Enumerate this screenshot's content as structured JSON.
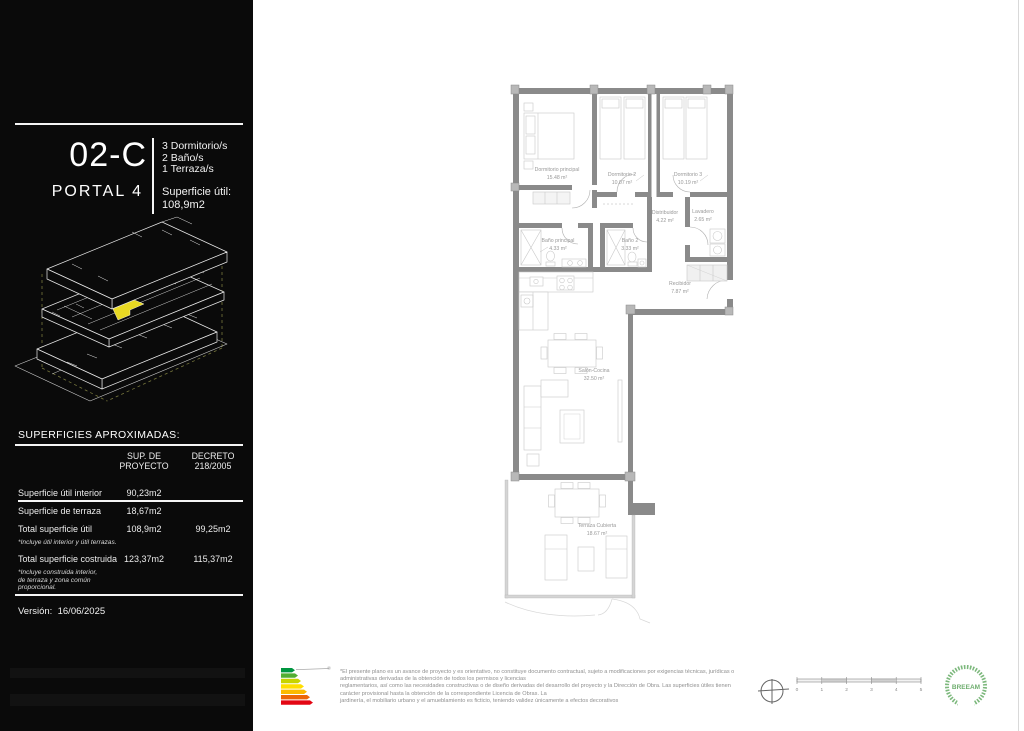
{
  "sidebar": {
    "unit_code": "02-C",
    "portal": "PORTAL 4",
    "features": [
      "3 Dormitorio/s",
      "2 Baño/s",
      "1 Terraza/s"
    ],
    "superficie_util_label": "Superficie útil:",
    "superficie_util_value": "108,9m2",
    "table": {
      "title": "SUPERFICIES APROXIMADAS:",
      "col_proyecto": "SUP. DE\nPROYECTO",
      "col_decreto": "DECRETO\n218/2005",
      "rows": [
        {
          "label": "Superficie útil interior",
          "proyecto": "90,23m2",
          "decreto": ""
        },
        {
          "label": "Superficie de terraza",
          "proyecto": "18,67m2",
          "decreto": ""
        },
        {
          "label": "Total superficie útil",
          "proyecto": "108,9m2",
          "decreto": "99,25m2",
          "note": "*Incluye útil interior y útil terrazas."
        },
        {
          "label": "Total superficie costruida",
          "proyecto": "123,37m2",
          "decreto": "115,37m2",
          "note": "*Incluye construida interior,\nde terraza y zona común\nproporcional."
        }
      ]
    },
    "version_label": "Versión:",
    "version_value": "16/06/2025"
  },
  "plan": {
    "rooms": [
      {
        "name": "Dormitorio principal",
        "area": "15.48 m²"
      },
      {
        "name": "Dormitorio 2",
        "area": "10.07 m²"
      },
      {
        "name": "Dormitorio 3",
        "area": "10.19 m²"
      },
      {
        "name": "Distribuidor",
        "area": "4.22 m²"
      },
      {
        "name": "Lavadero",
        "area": "2.65 m²"
      },
      {
        "name": "Baño principal",
        "area": "4.33 m²"
      },
      {
        "name": "Baño 2",
        "area": "3.33 m²"
      },
      {
        "name": "Recibidor",
        "area": "7.87 m²"
      },
      {
        "name": "Salón-Cocina",
        "area": "32.50 m²"
      },
      {
        "name": "Terraza Cubierta",
        "area": "18.67 m²"
      }
    ]
  },
  "footer": {
    "disclaimer_lines": [
      "*El presente plano es un avance de proyecto y es orientativo, no constituye documento contractual, sujeto a modificaciones por exigencias técnicas, jurídicas o",
      "administrativas derivadas de la obtención de todos los permisos y licencias",
      "reglamentarios, así como las necesidades constructivas o de diseño derivadas del desarrollo del proyecto y la Dirección de Obra. Las superficies útiles tienen",
      "carácter provisional hasta la obtención de la correspondiente Licencia de Obras. La",
      "jardinería, el mobiliario urbano y el amueblamiento es ficticio, teniendo validez únicamente a efectos decorativos"
    ],
    "scale_ticks": [
      "0",
      "1",
      "2",
      "3",
      "4",
      "5"
    ],
    "breeam_label": "BREEAM"
  },
  "colors": {
    "highlight_unit": "#e8d923",
    "wall_gray": "#8a8a8a",
    "energy_scale": [
      "#009640",
      "#52ae32",
      "#c8d400",
      "#ffde00",
      "#fbba00",
      "#ec6608",
      "#e30613"
    ],
    "breeam_green": "#7cb87c"
  }
}
